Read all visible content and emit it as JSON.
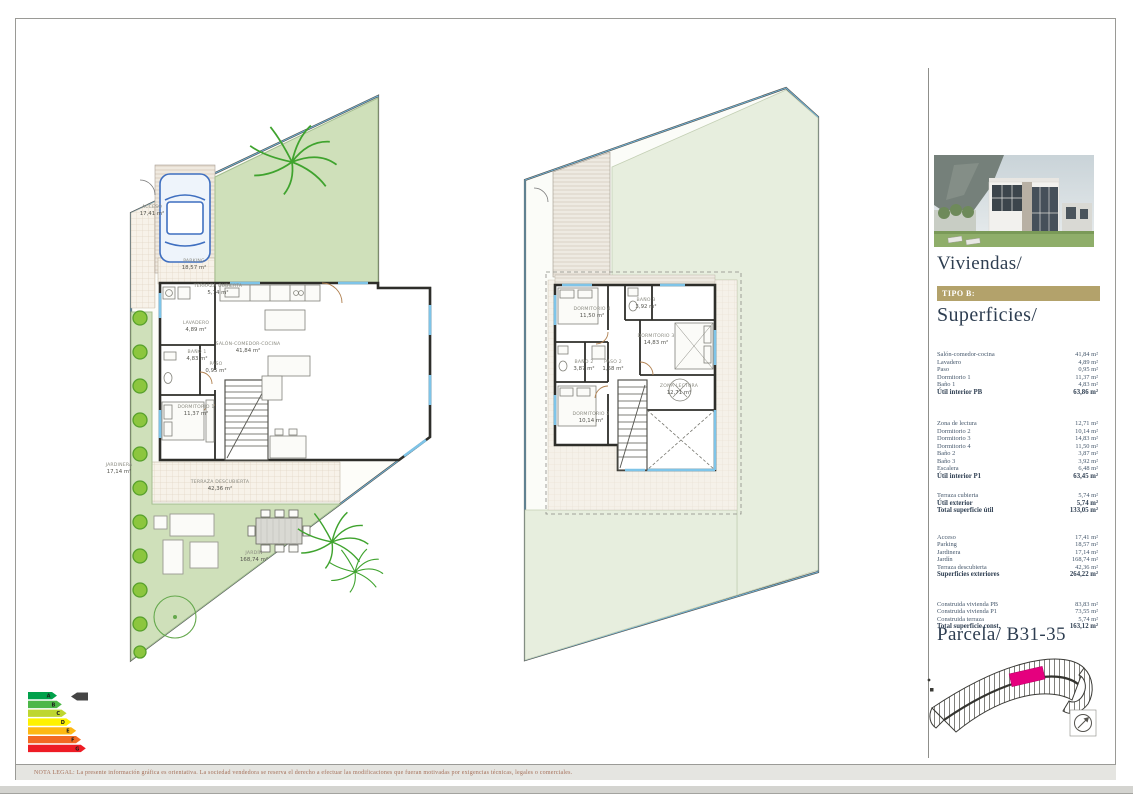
{
  "document": {
    "disclaimer": "NOTA LEGAL: La presente información gráfica es orientativa. La sociedad vendedora se reserva el derecho a efectuar las modificaciones que fueran motivadas por exigencias técnicas, legales o comerciales."
  },
  "sidebar": {
    "title": "Viviendas/",
    "tipo_label": "TIPO B:",
    "superficies_title": "Superficies/",
    "parcela_title": "Parcela/ B31-35",
    "accent_color": "#b3a26b",
    "title_color": "#2e3e51",
    "sections": [
      {
        "rows": [
          {
            "label": "Salón-comedor-cocina",
            "value": "41,84 m²"
          },
          {
            "label": "Lavadero",
            "value": "4,89 m²"
          },
          {
            "label": "Paso",
            "value": "0,95 m²"
          },
          {
            "label": "Dormitorio 1",
            "value": "11,37 m²"
          },
          {
            "label": "Baño 1",
            "value": "4,83 m²"
          },
          {
            "label": "Útil interior PB",
            "value": "63,86 m²"
          }
        ]
      },
      {
        "rows": [
          {
            "label": "Zona de lectura",
            "value": "12,71 m²"
          },
          {
            "label": "Dormitorio 2",
            "value": "10,14 m²"
          },
          {
            "label": "Dormitorio 3",
            "value": "14,83 m²"
          },
          {
            "label": "Dormitorio 4",
            "value": "11,50 m²"
          },
          {
            "label": "Baño 2",
            "value": "3,87 m²"
          },
          {
            "label": "Baño 3",
            "value": "3,92 m²"
          },
          {
            "label": "Escalera",
            "value": "6,48 m²"
          },
          {
            "label": "Útil interior P1",
            "value": "63,45 m²"
          }
        ]
      },
      {
        "rows": [
          {
            "label": "Terraza cubierta",
            "value": "5,74 m²"
          },
          {
            "label": "Útil exterior",
            "value": "5,74 m²"
          },
          {
            "label": "Total superficie útil",
            "value": "133,05 m²"
          }
        ]
      },
      {
        "rows": [
          {
            "label": "Acceso",
            "value": "17,41 m²"
          },
          {
            "label": "Parking",
            "value": "18,57 m²"
          },
          {
            "label": "Jardinera",
            "value": "17,14 m²"
          },
          {
            "label": "Jardín",
            "value": "168,74 m²"
          },
          {
            "label": "Terraza descubierta",
            "value": "42,36 m²"
          },
          {
            "label": "Superficies exteriores",
            "value": "264,22 m²"
          }
        ]
      },
      {
        "rows": [
          {
            "label": "Construida vivienda PB",
            "value": "83,83 m²"
          },
          {
            "label": "Construida vivienda P1",
            "value": "73,55 m²"
          },
          {
            "label": "Construida terraza",
            "value": "5,74 m²"
          },
          {
            "label": "Total superficie const.",
            "value": "163,12 m²"
          }
        ]
      }
    ]
  },
  "plan_ground": {
    "labels": [
      {
        "name": "TERRAZA CUBIERTA",
        "value": "5,74 m²"
      },
      {
        "name": "LAVADERO",
        "value": "4,89 m²"
      },
      {
        "name": "BAÑO 1",
        "value": "4,83 m²"
      },
      {
        "name": "PASO",
        "value": "0,95 m²"
      },
      {
        "name": "SALÓN-COMEDOR-COCINA",
        "value": "41,84 m²"
      },
      {
        "name": "DORMITORIO 1",
        "value": "11,37 m²"
      },
      {
        "name": "TERRAZA DESCUBIERTA",
        "value": "42,36 m²"
      },
      {
        "name": "JARDÍN",
        "value": "168,74 m²"
      },
      {
        "name": "PARKING",
        "value": "18,57 m²"
      },
      {
        "name": "ACCESO",
        "value": "17,41 m²"
      },
      {
        "name": "JARDINERA",
        "value": "17,14 m²"
      }
    ]
  },
  "plan_first": {
    "labels": [
      {
        "name": "DORMITORIO 4",
        "value": "11,50 m²"
      },
      {
        "name": "BAÑO 3",
        "value": "3,92 m²"
      },
      {
        "name": "DORMITORIO 3",
        "value": "14,83 m²"
      },
      {
        "name": "BAÑO 2",
        "value": "3,87 m²"
      },
      {
        "name": "PASO 2",
        "value": "1,58 m²"
      },
      {
        "name": "DORMITORIO 2",
        "value": "10,14 m²"
      },
      {
        "name": "ZONA LECTURA",
        "value": "12,71 m²"
      }
    ]
  },
  "energy": {
    "letters": [
      "A",
      "B",
      "C",
      "D",
      "E",
      "F",
      "G"
    ],
    "colors": [
      "#00a14b",
      "#4cb748",
      "#bed630",
      "#fef200",
      "#fdb813",
      "#f26922",
      "#ee1c25"
    ]
  },
  "siteplan": {
    "highlight_color": "#e5007e"
  }
}
